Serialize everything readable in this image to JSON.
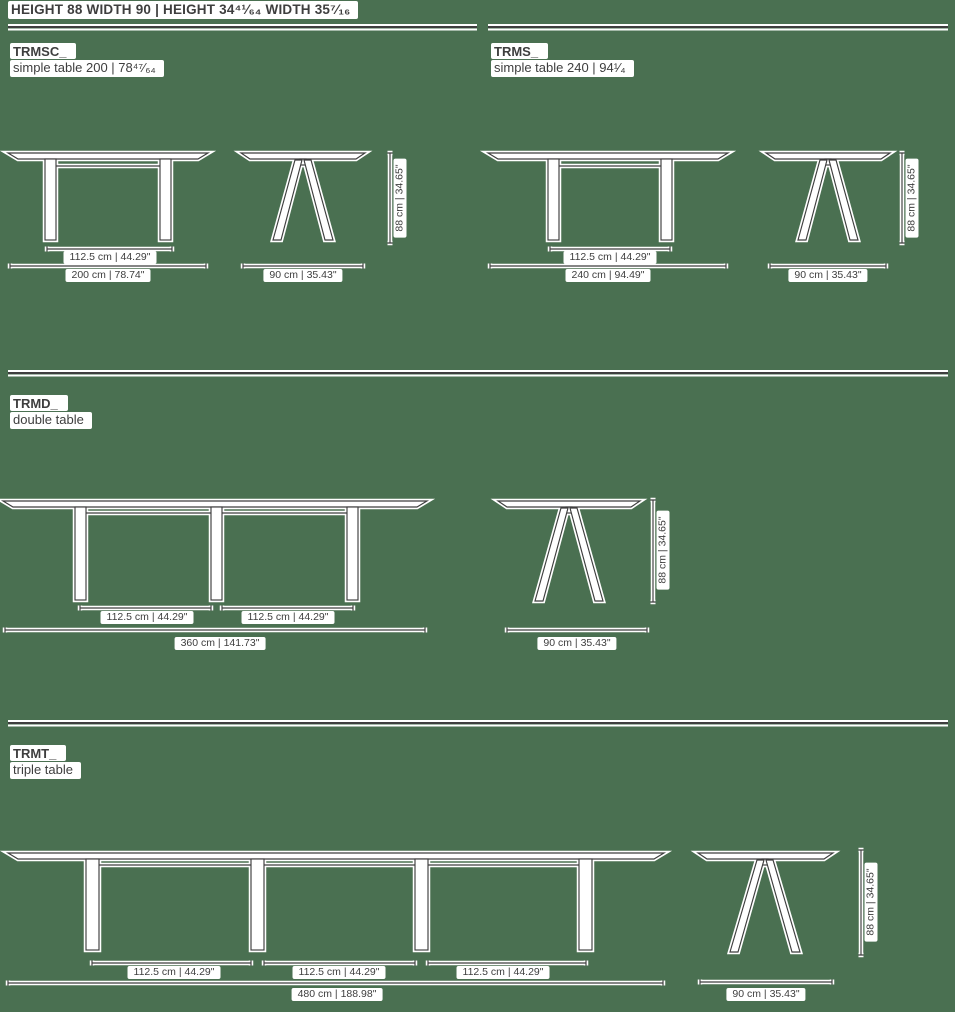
{
  "page": {
    "background_color": "#4a7051",
    "ink_color": "#3e3e3e"
  },
  "header": {
    "spec": "HEIGHT 88 WIDTH 90 | HEIGHT 34⁴¹⁄₆₄ WIDTH 35⁷⁄₁₆"
  },
  "sections": [
    {
      "code": "TRMSC_",
      "name": "simple table 200 | 78⁴⁷⁄₆₄",
      "total": "200 cm | 78.74\""
    },
    {
      "code": "TRMS_",
      "name": "simple table 240 | 94¹⁄₄",
      "total": "240 cm | 94.49\""
    },
    {
      "code": "TRMD_",
      "name": "double table",
      "total": "360 cm | 141.73\""
    },
    {
      "code": "TRMT_",
      "name": "triple table",
      "total": "480 cm | 188.98\""
    }
  ],
  "labels": {
    "span": "112.5 cm | 44.29\"",
    "depth": "90 cm | 35.43\"",
    "height": "88 cm | 34.65\""
  }
}
